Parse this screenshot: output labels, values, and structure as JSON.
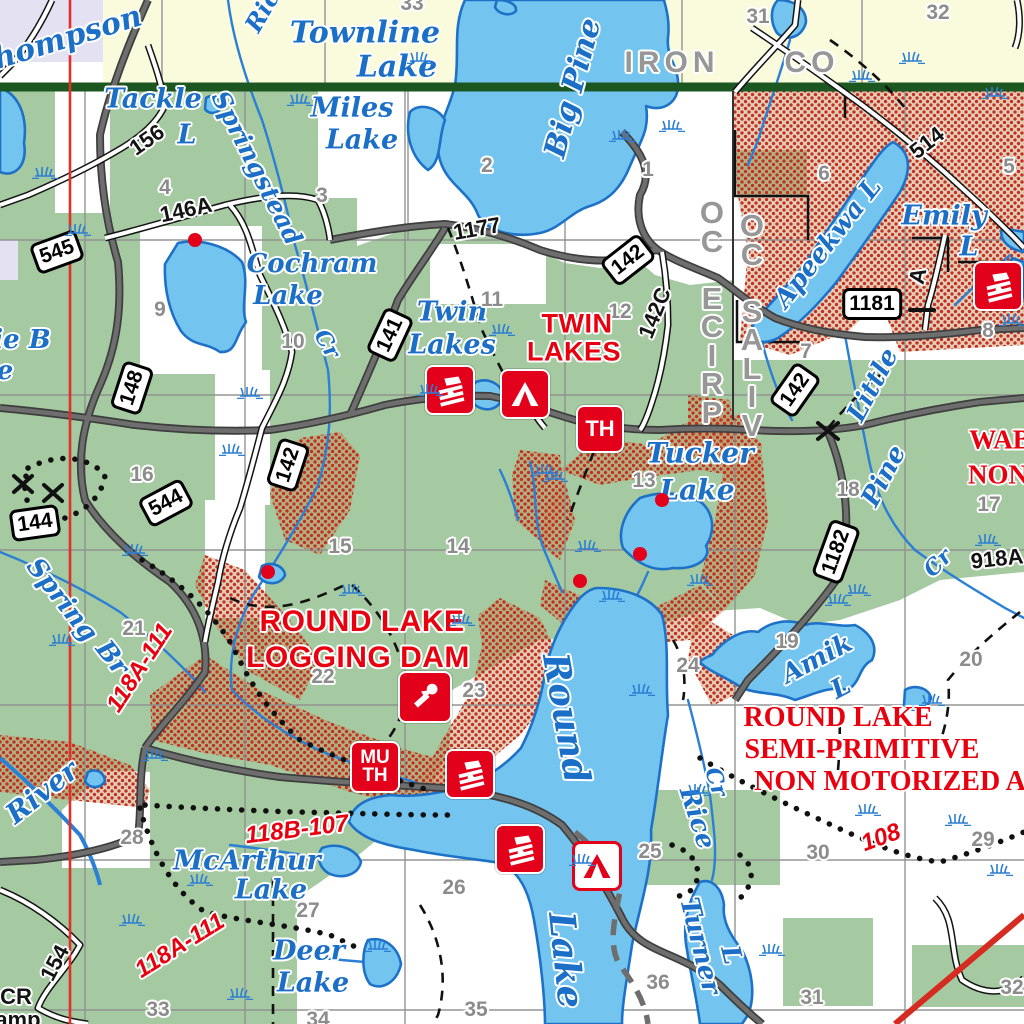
{
  "map_title": "Round Lake / Twin Lakes area recreation map",
  "counties": {
    "iron": "IRON",
    "iron_co": "CO",
    "price": "PRICE CO",
    "vilas": "VILAS CO"
  },
  "red_area_labels": [
    {
      "t": "TWIN",
      "x": 577,
      "y": 324,
      "r": 0,
      "s": 27,
      "f": "sans"
    },
    {
      "t": "LAKES",
      "x": 574,
      "y": 352,
      "r": 0,
      "s": 27,
      "f": "sans"
    },
    {
      "t": "ROUND LAKE",
      "x": 362,
      "y": 622,
      "r": 0,
      "s": 30,
      "f": "sans"
    },
    {
      "t": "LOGGING DAM",
      "x": 358,
      "y": 658,
      "r": 0,
      "s": 30,
      "f": "sans"
    },
    {
      "t": "ROUND LAKE",
      "x": 838,
      "y": 718,
      "r": 0,
      "s": 28,
      "f": "serif"
    },
    {
      "t": "SEMI-PRIMITIVE",
      "x": 862,
      "y": 750,
      "r": 0,
      "s": 28,
      "f": "serif"
    },
    {
      "t": "NON MOTORIZED A",
      "x": 890,
      "y": 782,
      "r": 0,
      "s": 28,
      "f": "serif"
    },
    {
      "t": "WAB",
      "x": 1000,
      "y": 440,
      "r": 0,
      "s": 27,
      "f": "serif"
    },
    {
      "t": "NON",
      "x": 998,
      "y": 475,
      "r": 0,
      "s": 27,
      "f": "serif"
    }
  ],
  "red_route_labels": [
    {
      "t": "118A-111",
      "x": 140,
      "y": 668,
      "r": -57,
      "s": 24
    },
    {
      "t": "118A-111",
      "x": 180,
      "y": 946,
      "r": -32,
      "s": 24
    },
    {
      "t": "118B-107",
      "x": 297,
      "y": 830,
      "r": -7,
      "s": 24
    },
    {
      "t": "108",
      "x": 881,
      "y": 838,
      "r": -20,
      "s": 24
    }
  ],
  "lake_labels": [
    {
      "t": "Thompson",
      "x": 57,
      "y": 41,
      "r": -17,
      "s": 30
    },
    {
      "t": "Townline",
      "x": 365,
      "y": 33,
      "r": 0,
      "s": 30
    },
    {
      "t": "Lake",
      "x": 397,
      "y": 67,
      "r": 0,
      "s": 30
    },
    {
      "t": "Miles",
      "x": 352,
      "y": 108,
      "r": 0,
      "s": 27
    },
    {
      "t": "Lake",
      "x": 362,
      "y": 140,
      "r": 0,
      "s": 27
    },
    {
      "t": "Tackle",
      "x": 153,
      "y": 99,
      "r": 0,
      "s": 27
    },
    {
      "t": "L",
      "x": 187,
      "y": 135,
      "r": 0,
      "s": 27
    },
    {
      "t": "Ric",
      "x": 262,
      "y": 11,
      "r": -60,
      "s": 24
    },
    {
      "t": "Big Pine",
      "x": 573,
      "y": 88,
      "r": -75,
      "s": 30
    },
    {
      "t": "Springstead",
      "x": 257,
      "y": 168,
      "r": 63,
      "s": 25
    },
    {
      "t": "Cr",
      "x": 327,
      "y": 344,
      "r": 60,
      "s": 22
    },
    {
      "t": "Cochram",
      "x": 312,
      "y": 264,
      "r": 0,
      "s": 26
    },
    {
      "t": "Lake",
      "x": 288,
      "y": 296,
      "r": 0,
      "s": 26
    },
    {
      "t": "ie B",
      "x": 22,
      "y": 340,
      "r": 0,
      "s": 26
    },
    {
      "t": "e",
      "x": 5,
      "y": 371,
      "r": 0,
      "s": 26
    },
    {
      "t": "Twin",
      "x": 452,
      "y": 312,
      "r": 0,
      "s": 27
    },
    {
      "t": "Lakes",
      "x": 452,
      "y": 345,
      "r": 0,
      "s": 27
    },
    {
      "t": "Apeekwa L",
      "x": 828,
      "y": 243,
      "r": -52,
      "s": 26
    },
    {
      "t": "Emily",
      "x": 944,
      "y": 216,
      "r": 0,
      "s": 27
    },
    {
      "t": "L",
      "x": 969,
      "y": 247,
      "r": 0,
      "s": 27
    },
    {
      "t": "Tucker",
      "x": 700,
      "y": 453,
      "r": 0,
      "s": 28
    },
    {
      "t": "Lake",
      "x": 697,
      "y": 490,
      "r": 0,
      "s": 28
    },
    {
      "t": "Little",
      "x": 873,
      "y": 385,
      "r": -62,
      "s": 26
    },
    {
      "t": "Pine",
      "x": 884,
      "y": 476,
      "r": -62,
      "s": 26
    },
    {
      "t": "Cr",
      "x": 938,
      "y": 563,
      "r": -45,
      "s": 22
    },
    {
      "t": "Spring",
      "x": 62,
      "y": 600,
      "r": 52,
      "s": 26
    },
    {
      "t": "Br",
      "x": 112,
      "y": 658,
      "r": 52,
      "s": 26
    },
    {
      "t": "Round",
      "x": 566,
      "y": 718,
      "r": 80,
      "s": 36
    },
    {
      "t": "Lake",
      "x": 566,
      "y": 960,
      "r": 84,
      "s": 36
    },
    {
      "t": "Amik",
      "x": 817,
      "y": 659,
      "r": -28,
      "s": 26
    },
    {
      "t": "L",
      "x": 841,
      "y": 688,
      "r": -28,
      "s": 26
    },
    {
      "t": "Turner",
      "x": 700,
      "y": 946,
      "r": 76,
      "s": 26
    },
    {
      "t": "L",
      "x": 731,
      "y": 955,
      "r": 76,
      "s": 26
    },
    {
      "t": "Rice",
      "x": 697,
      "y": 818,
      "r": 72,
      "s": 26
    },
    {
      "t": "Cr",
      "x": 716,
      "y": 782,
      "r": 72,
      "s": 22
    },
    {
      "t": "McArthur",
      "x": 247,
      "y": 861,
      "r": 0,
      "s": 27
    },
    {
      "t": "Lake",
      "x": 271,
      "y": 890,
      "r": 0,
      "s": 27
    },
    {
      "t": "Deer",
      "x": 309,
      "y": 951,
      "r": 0,
      "s": 27
    },
    {
      "t": "Lake",
      "x": 313,
      "y": 983,
      "r": 0,
      "s": 27
    },
    {
      "t": "River",
      "x": 42,
      "y": 792,
      "r": -38,
      "s": 28
    }
  ],
  "road_labels": [
    {
      "t": "1177",
      "x": 477,
      "y": 229,
      "r": -10
    },
    {
      "t": "146A",
      "x": 186,
      "y": 210,
      "r": -12
    },
    {
      "t": "156",
      "x": 147,
      "y": 140,
      "r": -35
    },
    {
      "t": "142C",
      "x": 655,
      "y": 313,
      "r": -68
    },
    {
      "t": "514",
      "x": 927,
      "y": 143,
      "r": -38
    },
    {
      "t": "A",
      "x": 918,
      "y": 276,
      "r": -78
    },
    {
      "t": "918A",
      "x": 997,
      "y": 559,
      "r": -6
    },
    {
      "t": "154",
      "x": 55,
      "y": 963,
      "r": -62
    },
    {
      "t": "CR",
      "x": 16,
      "y": 997,
      "r": 0
    },
    {
      "t": "Camp",
      "x": 10,
      "y": 1020,
      "r": 0
    }
  ],
  "shields": [
    {
      "n": "545",
      "x": 57,
      "y": 252,
      "r": -20
    },
    {
      "n": "148",
      "x": 132,
      "y": 388,
      "r": -72
    },
    {
      "n": "544",
      "x": 166,
      "y": 503,
      "r": -28
    },
    {
      "n": "144",
      "x": 35,
      "y": 523,
      "r": -8
    },
    {
      "n": "142",
      "x": 288,
      "y": 465,
      "r": -72
    },
    {
      "n": "141",
      "x": 390,
      "y": 335,
      "r": -65
    },
    {
      "n": "142",
      "x": 628,
      "y": 260,
      "r": -38
    },
    {
      "n": "142",
      "x": 795,
      "y": 390,
      "r": -55
    },
    {
      "n": "1181",
      "x": 872,
      "y": 304,
      "r": 0
    },
    {
      "n": "1182",
      "x": 836,
      "y": 552,
      "r": -70
    }
  ],
  "section_numbers": [
    {
      "t": "31",
      "x": 758,
      "y": 17
    },
    {
      "t": "32",
      "x": 938,
      "y": 13
    },
    {
      "t": "33",
      "x": 412,
      "y": 4
    },
    {
      "t": "4",
      "x": 165,
      "y": 188
    },
    {
      "t": "3",
      "x": 322,
      "y": 196
    },
    {
      "t": "2",
      "x": 487,
      "y": 166
    },
    {
      "t": "1",
      "x": 648,
      "y": 170
    },
    {
      "t": "6",
      "x": 824,
      "y": 174
    },
    {
      "t": "5",
      "x": 1009,
      "y": 167
    },
    {
      "t": "9",
      "x": 160,
      "y": 310
    },
    {
      "t": "10",
      "x": 293,
      "y": 342
    },
    {
      "t": "11",
      "x": 492,
      "y": 300
    },
    {
      "t": "12",
      "x": 620,
      "y": 312
    },
    {
      "t": "7",
      "x": 806,
      "y": 352
    },
    {
      "t": "8",
      "x": 988,
      "y": 331
    },
    {
      "t": "16",
      "x": 142,
      "y": 475
    },
    {
      "t": "15",
      "x": 340,
      "y": 547
    },
    {
      "t": "14",
      "x": 458,
      "y": 547
    },
    {
      "t": "13",
      "x": 644,
      "y": 481
    },
    {
      "t": "18",
      "x": 848,
      "y": 490
    },
    {
      "t": "17",
      "x": 989,
      "y": 505
    },
    {
      "t": "21",
      "x": 134,
      "y": 629
    },
    {
      "t": "22",
      "x": 323,
      "y": 677
    },
    {
      "t": "23",
      "x": 474,
      "y": 691
    },
    {
      "t": "24",
      "x": 688,
      "y": 666
    },
    {
      "t": "19",
      "x": 787,
      "y": 642
    },
    {
      "t": "20",
      "x": 971,
      "y": 660
    },
    {
      "t": "28",
      "x": 132,
      "y": 838
    },
    {
      "t": "27",
      "x": 308,
      "y": 911
    },
    {
      "t": "26",
      "x": 454,
      "y": 888
    },
    {
      "t": "25",
      "x": 650,
      "y": 852
    },
    {
      "t": "30",
      "x": 818,
      "y": 853
    },
    {
      "t": "29",
      "x": 983,
      "y": 840
    },
    {
      "t": "33",
      "x": 158,
      "y": 1010
    },
    {
      "t": "34",
      "x": 318,
      "y": 1020
    },
    {
      "t": "35",
      "x": 476,
      "y": 1010
    },
    {
      "t": "36",
      "x": 658,
      "y": 983
    },
    {
      "t": "31",
      "x": 812,
      "y": 998
    },
    {
      "t": "32",
      "x": 1012,
      "y": 988
    }
  ],
  "poi_icons": [
    {
      "type": "boat-launch",
      "x": 450,
      "y": 390,
      "w": 50,
      "h": 50
    },
    {
      "type": "boat-launch",
      "x": 470,
      "y": 774,
      "w": 50,
      "h": 50
    },
    {
      "type": "boat-launch",
      "x": 520,
      "y": 849,
      "w": 50,
      "h": 50
    },
    {
      "type": "boat-launch",
      "x": 998,
      "y": 286,
      "w": 50,
      "h": 50
    },
    {
      "type": "campground",
      "x": 525,
      "y": 394,
      "w": 50,
      "h": 50
    },
    {
      "type": "campground-rustic",
      "x": 597,
      "y": 866,
      "w": 50,
      "h": 50
    },
    {
      "type": "trailhead",
      "label": "TH",
      "x": 600,
      "y": 429,
      "w": 48,
      "h": 48
    },
    {
      "type": "mu-trailhead",
      "label": "MU\nTH",
      "x": 375,
      "y": 767,
      "w": 50,
      "h": 52
    },
    {
      "type": "logging-dam",
      "x": 425,
      "y": 697,
      "w": 54,
      "h": 52
    }
  ],
  "red_dots": [
    {
      "x": 195,
      "y": 240
    },
    {
      "x": 268,
      "y": 572
    },
    {
      "x": 580,
      "y": 581
    },
    {
      "x": 640,
      "y": 554
    },
    {
      "x": 662,
      "y": 500
    }
  ],
  "colors": {
    "forest_green": "#A5C9A0",
    "town_yellow": "#FAFADC",
    "lavender": "#E4E1F2",
    "lake_blue": "#74C4F0",
    "lake_edge": "#1D72C8",
    "stream_blue": "#2B7FD4",
    "county_green": "#1C5722",
    "poi_red": "#E2001A",
    "label_red": "#E8000F",
    "stipple_red": "#C43022",
    "road_gray": "#6E6E6E",
    "section_gray": "#8C8C8C"
  }
}
